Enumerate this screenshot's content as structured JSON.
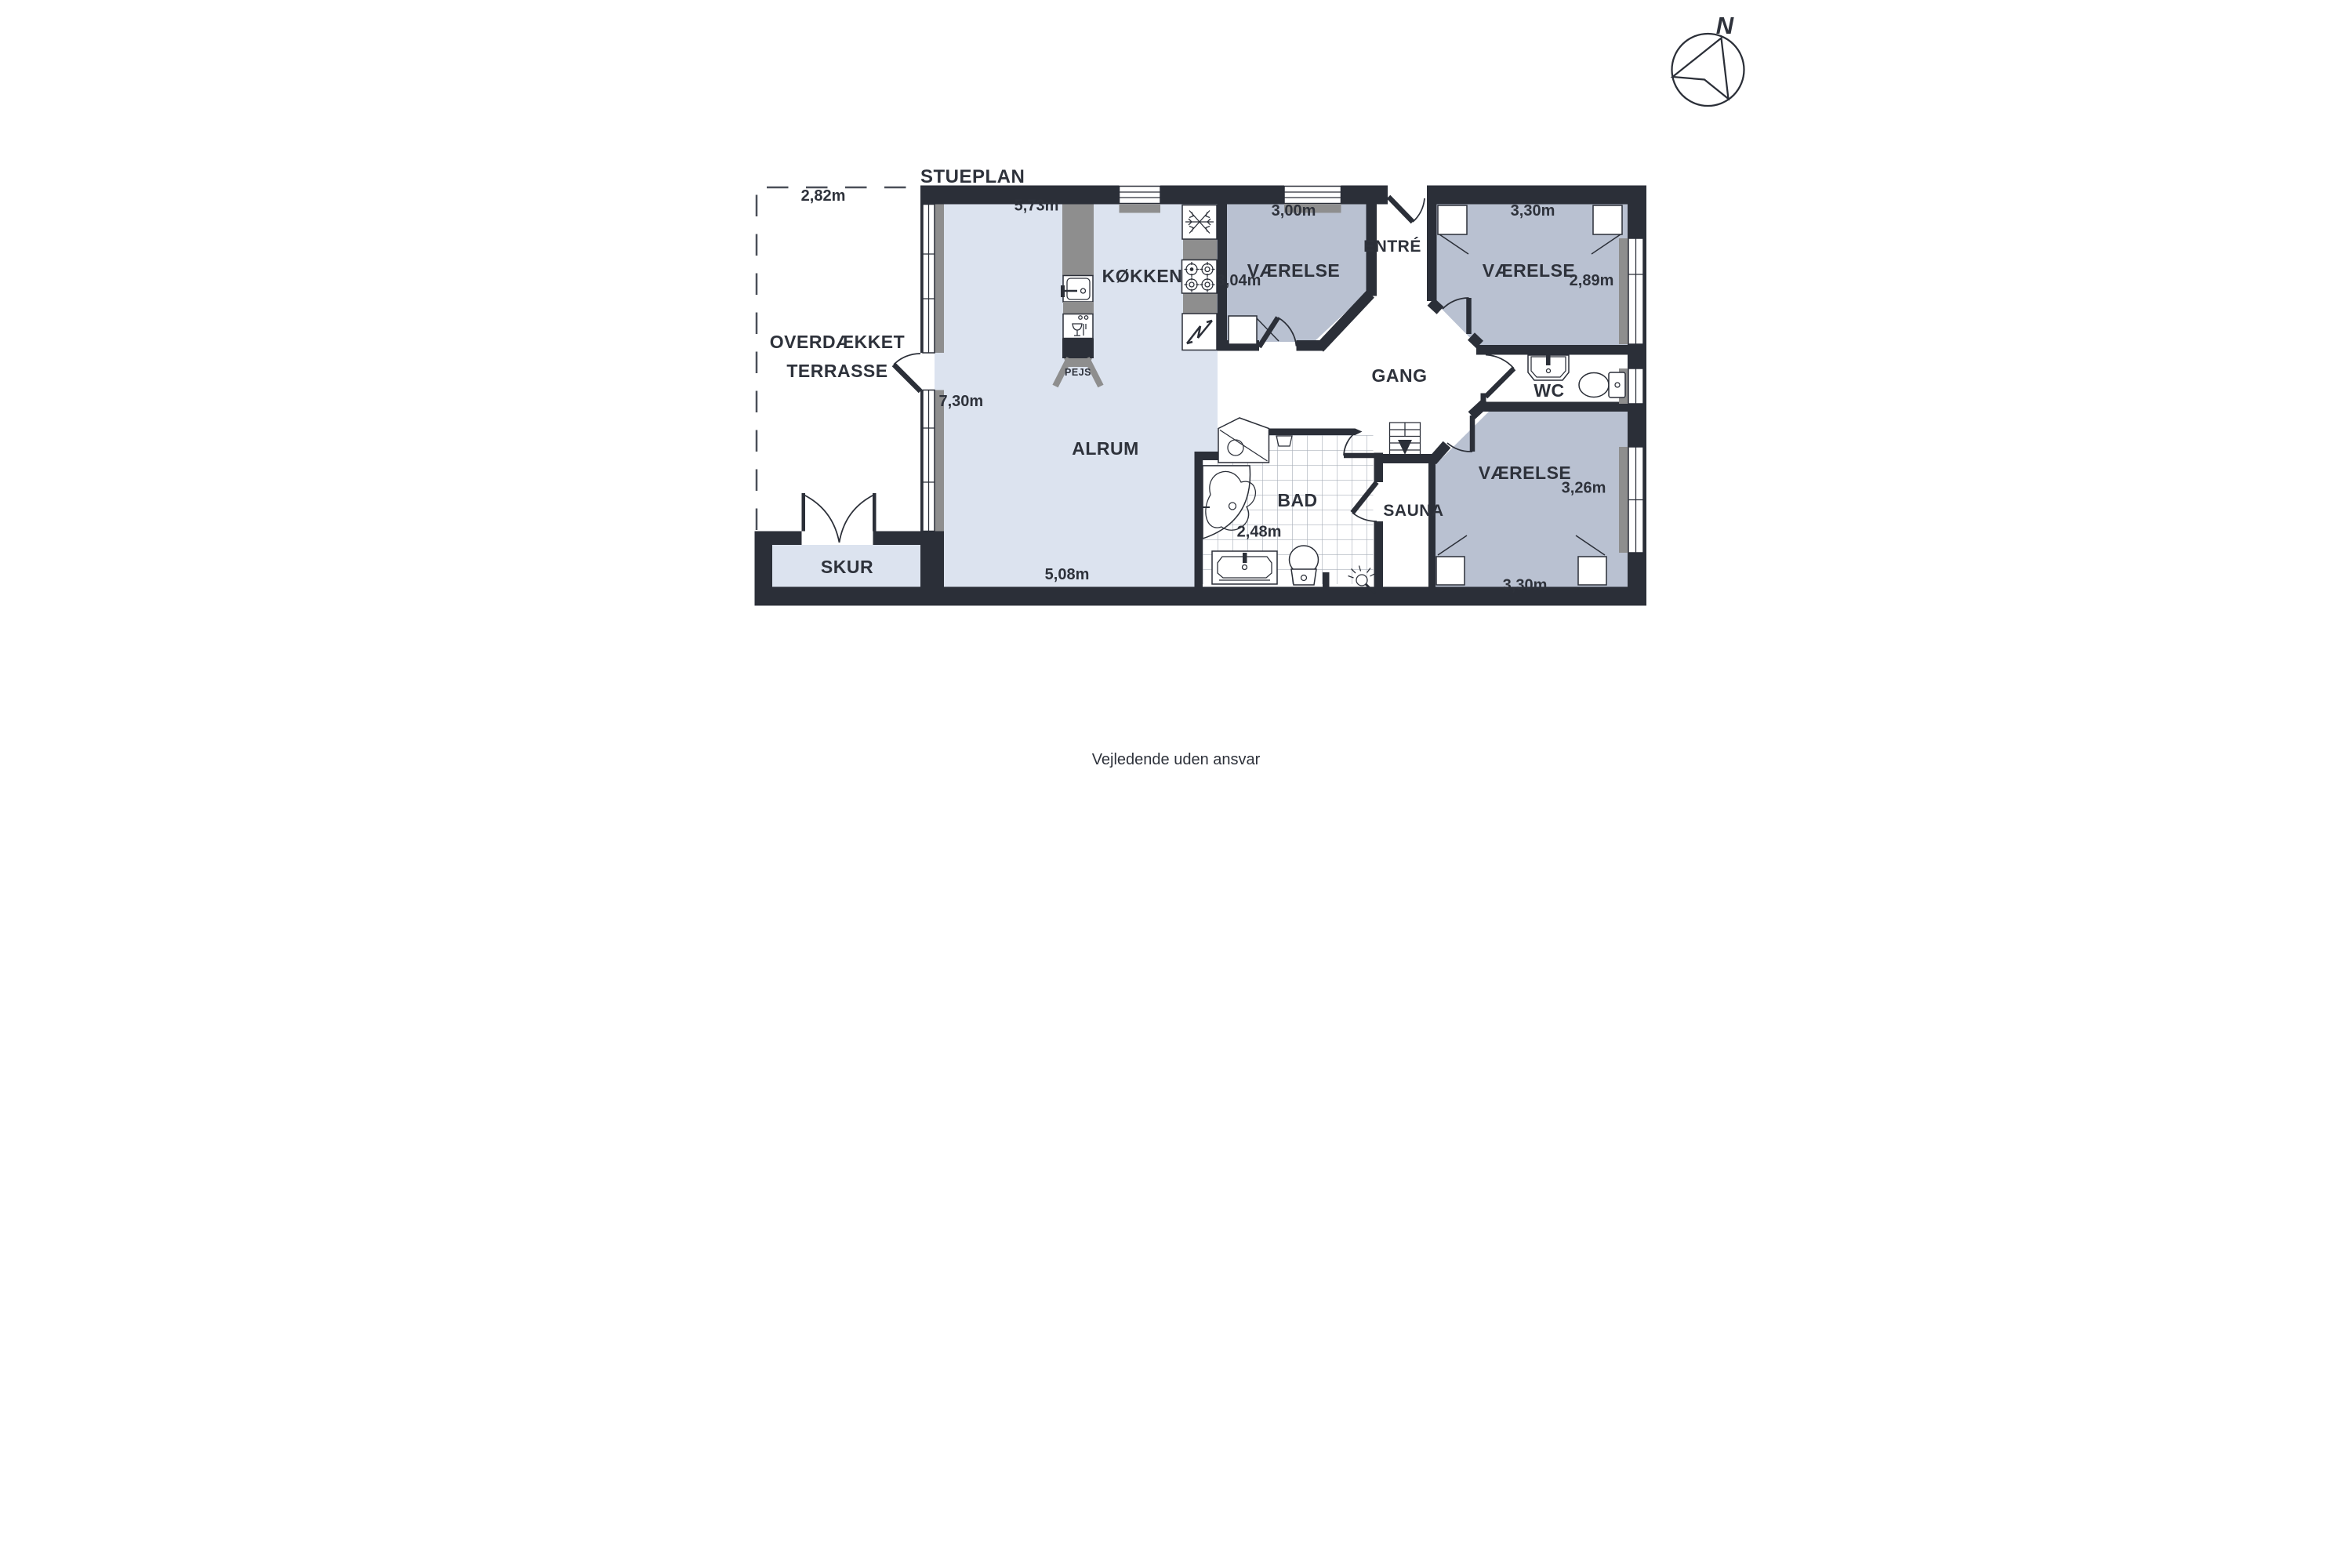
{
  "title": "STUEPLAN",
  "compass": {
    "north": "N"
  },
  "footer": {
    "disclaimer": "Vejledende uden ansvar"
  },
  "colors": {
    "wall": "#2b2f38",
    "floor_light": "#dce3ef",
    "floor_bedroom": "#b9c1d1",
    "counter": "#8e8e8e",
    "tile_line": "#a9b0ba",
    "text": "#2e323b"
  },
  "rooms": {
    "terrace": {
      "name_line1": "OVERDÆKKET",
      "name_line2": "TERRASSE",
      "width": "2,82m"
    },
    "shed": {
      "name": "SKUR"
    },
    "living_room": {
      "name": "ALRUM",
      "width_top": "5,73m",
      "depth_left": "7,30m",
      "width_bottom": "5,08m"
    },
    "kitchen": {
      "name": "KØKKEN"
    },
    "fireplace": {
      "name": "PEJS"
    },
    "bedroom_top_middle": {
      "name": "VÆRELSE",
      "width": "3,00m",
      "depth": "3,04m"
    },
    "entry": {
      "name": "ENTRÉ"
    },
    "hallway": {
      "name": "GANG"
    },
    "bedroom_top_right": {
      "name": "VÆRELSE",
      "width": "3,30m",
      "depth": "2,89m"
    },
    "wc": {
      "name": "WC"
    },
    "bathroom": {
      "name": "BAD",
      "width": "2,48m"
    },
    "sauna": {
      "name": "SAUNA"
    },
    "bedroom_bottom_right": {
      "name": "VÆRELSE",
      "depth": "3,26m",
      "width": "3,30m"
    }
  },
  "icons": {
    "compass": "north-arrow-circle",
    "kitchen_sink": "sink-basin",
    "dishwasher": "glass-and-fork",
    "freezer": "snowflake",
    "stove": "four-burners",
    "electrical": "lightning-bolt",
    "shower_cabin": "pentagon-shower-tray",
    "washing_machine": "laundry-tub",
    "bathtub": "corner-tub",
    "stairs": "stairs-down-arrow"
  }
}
